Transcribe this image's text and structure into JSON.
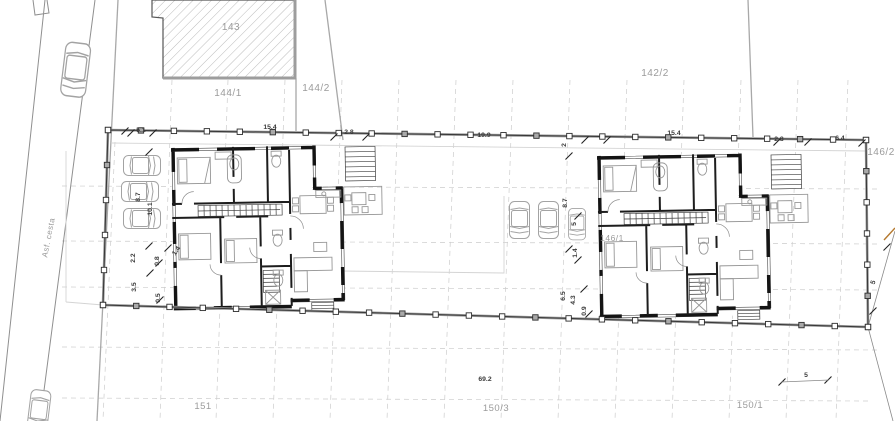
{
  "drawing": {
    "road_label": "Asf. cesta",
    "parcel_labels": [
      "143",
      "144/1",
      "144/2",
      "142/2",
      "146/2",
      "146/1",
      "151",
      "150/3",
      "150/1"
    ],
    "dimension_labels": [
      "5.1",
      "15.4",
      "2.8",
      "19.9",
      "2",
      "15.4",
      "2.8",
      "6.4",
      "8.7",
      "10.1",
      "2.2",
      "0.8",
      "1.4",
      "3.5",
      "0.5",
      "8.7",
      "5",
      "1.4",
      "6.5",
      "4.3",
      "0.9",
      "69.2",
      "5",
      "5"
    ],
    "colors": {
      "walls": "#141414",
      "parcel_text": "#9b9b9b",
      "dimension_text": "#3a3a3a",
      "fence": "#383838",
      "grid": "#cccccc",
      "hatch": "#ababab",
      "survey_mark": "#b5792f"
    }
  }
}
